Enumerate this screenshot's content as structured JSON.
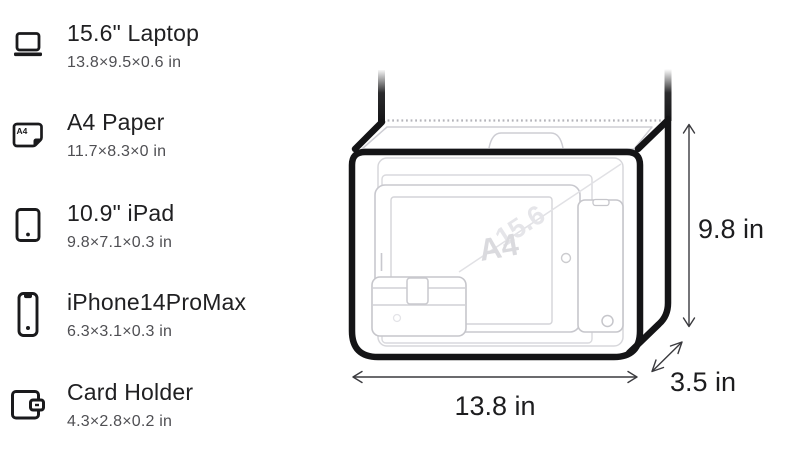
{
  "items": [
    {
      "title": "15.6\" Laptop",
      "dims": "13.8×9.5×0.6 in",
      "icon": "laptop-icon"
    },
    {
      "title": "A4 Paper",
      "dims": "11.7×8.3×0 in",
      "icon": "a4-paper-icon",
      "icon_label": "A4"
    },
    {
      "title": "10.9\" iPad",
      "dims": "9.8×7.1×0.3 in",
      "icon": "tablet-icon"
    },
    {
      "title": "iPhone14ProMax",
      "dims": "6.3×3.1×0.3 in",
      "icon": "phone-icon"
    },
    {
      "title": "Card Holder",
      "dims": "4.3×2.8×0.2 in",
      "icon": "wallet-icon"
    }
  ],
  "bag": {
    "height_label": "9.8 in",
    "width_label": "13.8 in",
    "depth_label": "3.5 in",
    "watermark_paper": "A4",
    "watermark_laptop": "15.6"
  },
  "colors": {
    "outline": "#141416",
    "text_primary": "#202022",
    "text_secondary": "#4f4f53",
    "ghost_line": "#c9c9cf",
    "watermark": "#dcdcdf"
  }
}
